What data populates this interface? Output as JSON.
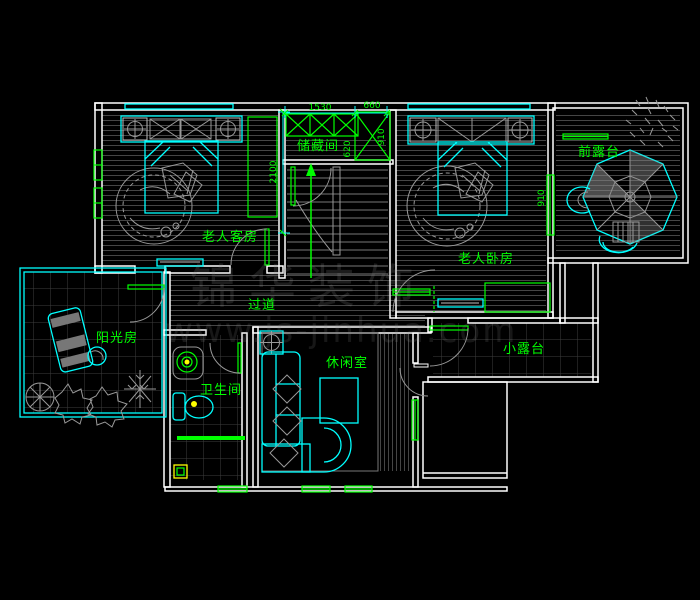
{
  "rooms": {
    "storage": {
      "label": "储藏间"
    },
    "guest_bedroom": {
      "label": "老人客房"
    },
    "master_bedroom": {
      "label": "老人卧房"
    },
    "front_terrace": {
      "label": "前露台"
    },
    "sunroom": {
      "label": "阳光房"
    },
    "corridor": {
      "label": "过道"
    },
    "bathroom": {
      "label": "卫生间"
    },
    "lounge": {
      "label": "休闲室"
    },
    "small_terrace": {
      "label": "小露台"
    }
  },
  "dimensions": {
    "storage_width": "1530",
    "storage_side": "660",
    "storage_depth": "620",
    "closet_height": "910",
    "stair_run": "2100",
    "terrace_window": "910"
  },
  "watermark": {
    "brand": "锦华装饰",
    "url": "www.js-jinhua.com"
  },
  "colors": {
    "background": "#000000",
    "wall": "#ffffff",
    "furniture": "#00ffff",
    "annotation": "#00ff00",
    "floor_line": "#454545",
    "accent": "#ffff00"
  }
}
